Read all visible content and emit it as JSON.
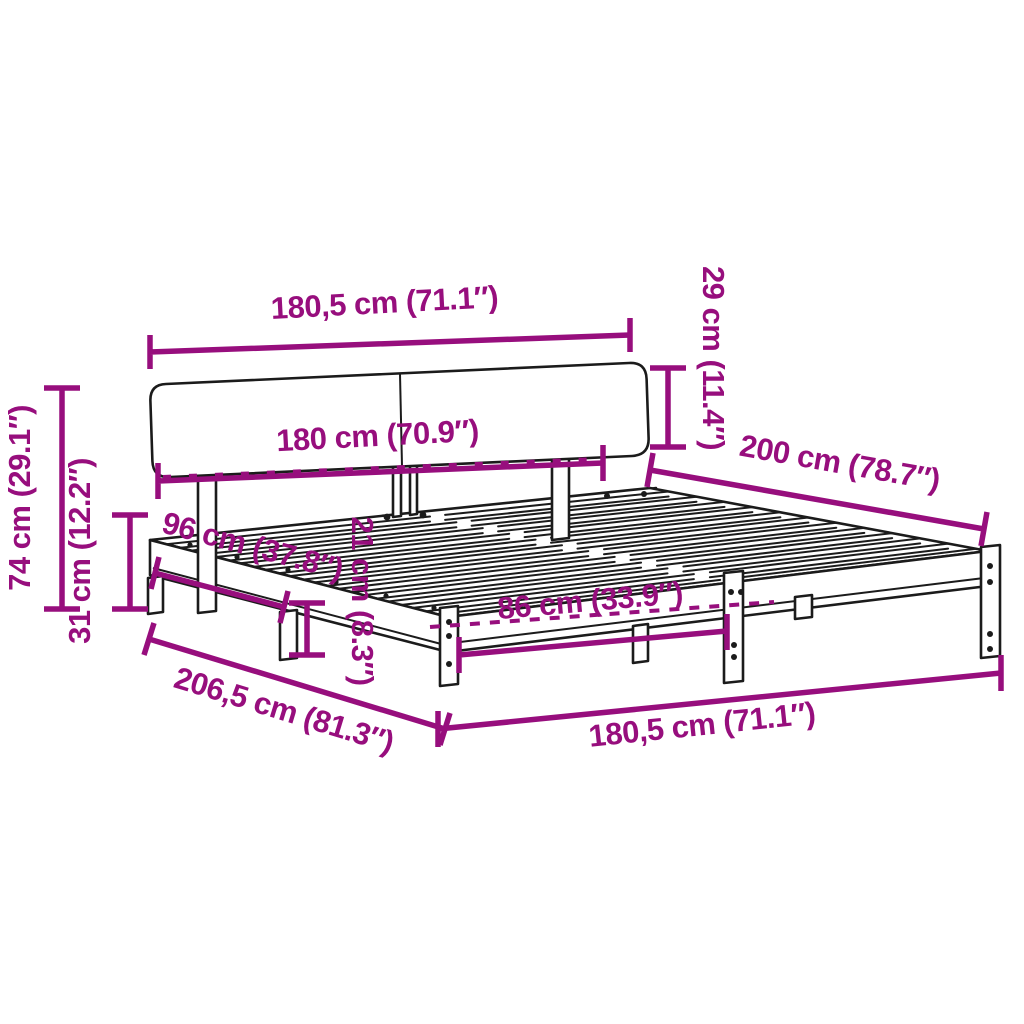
{
  "colors": {
    "dimension_accent": "#970E7D",
    "linework": "#1B1B1B",
    "background": "#FFFFFF"
  },
  "dimensions": {
    "headboard_width_top": "180,5 cm (71.1″)",
    "headboard_height": "29 cm (11.4″)",
    "mattress_width": "180 cm (70.9″)",
    "bed_length": "200 cm (78.7″)",
    "total_height": "74 cm (29.1″)",
    "base_height": "31 cm (12.2″)",
    "side_offset": "96 cm (37.8″)",
    "rail_height": "21 cm (8.3″)",
    "leg_spacing": "86 cm (33.9″)",
    "total_length": "206,5 cm (81.3″)",
    "frame_width_front": "180,5 cm (71.1″)"
  }
}
